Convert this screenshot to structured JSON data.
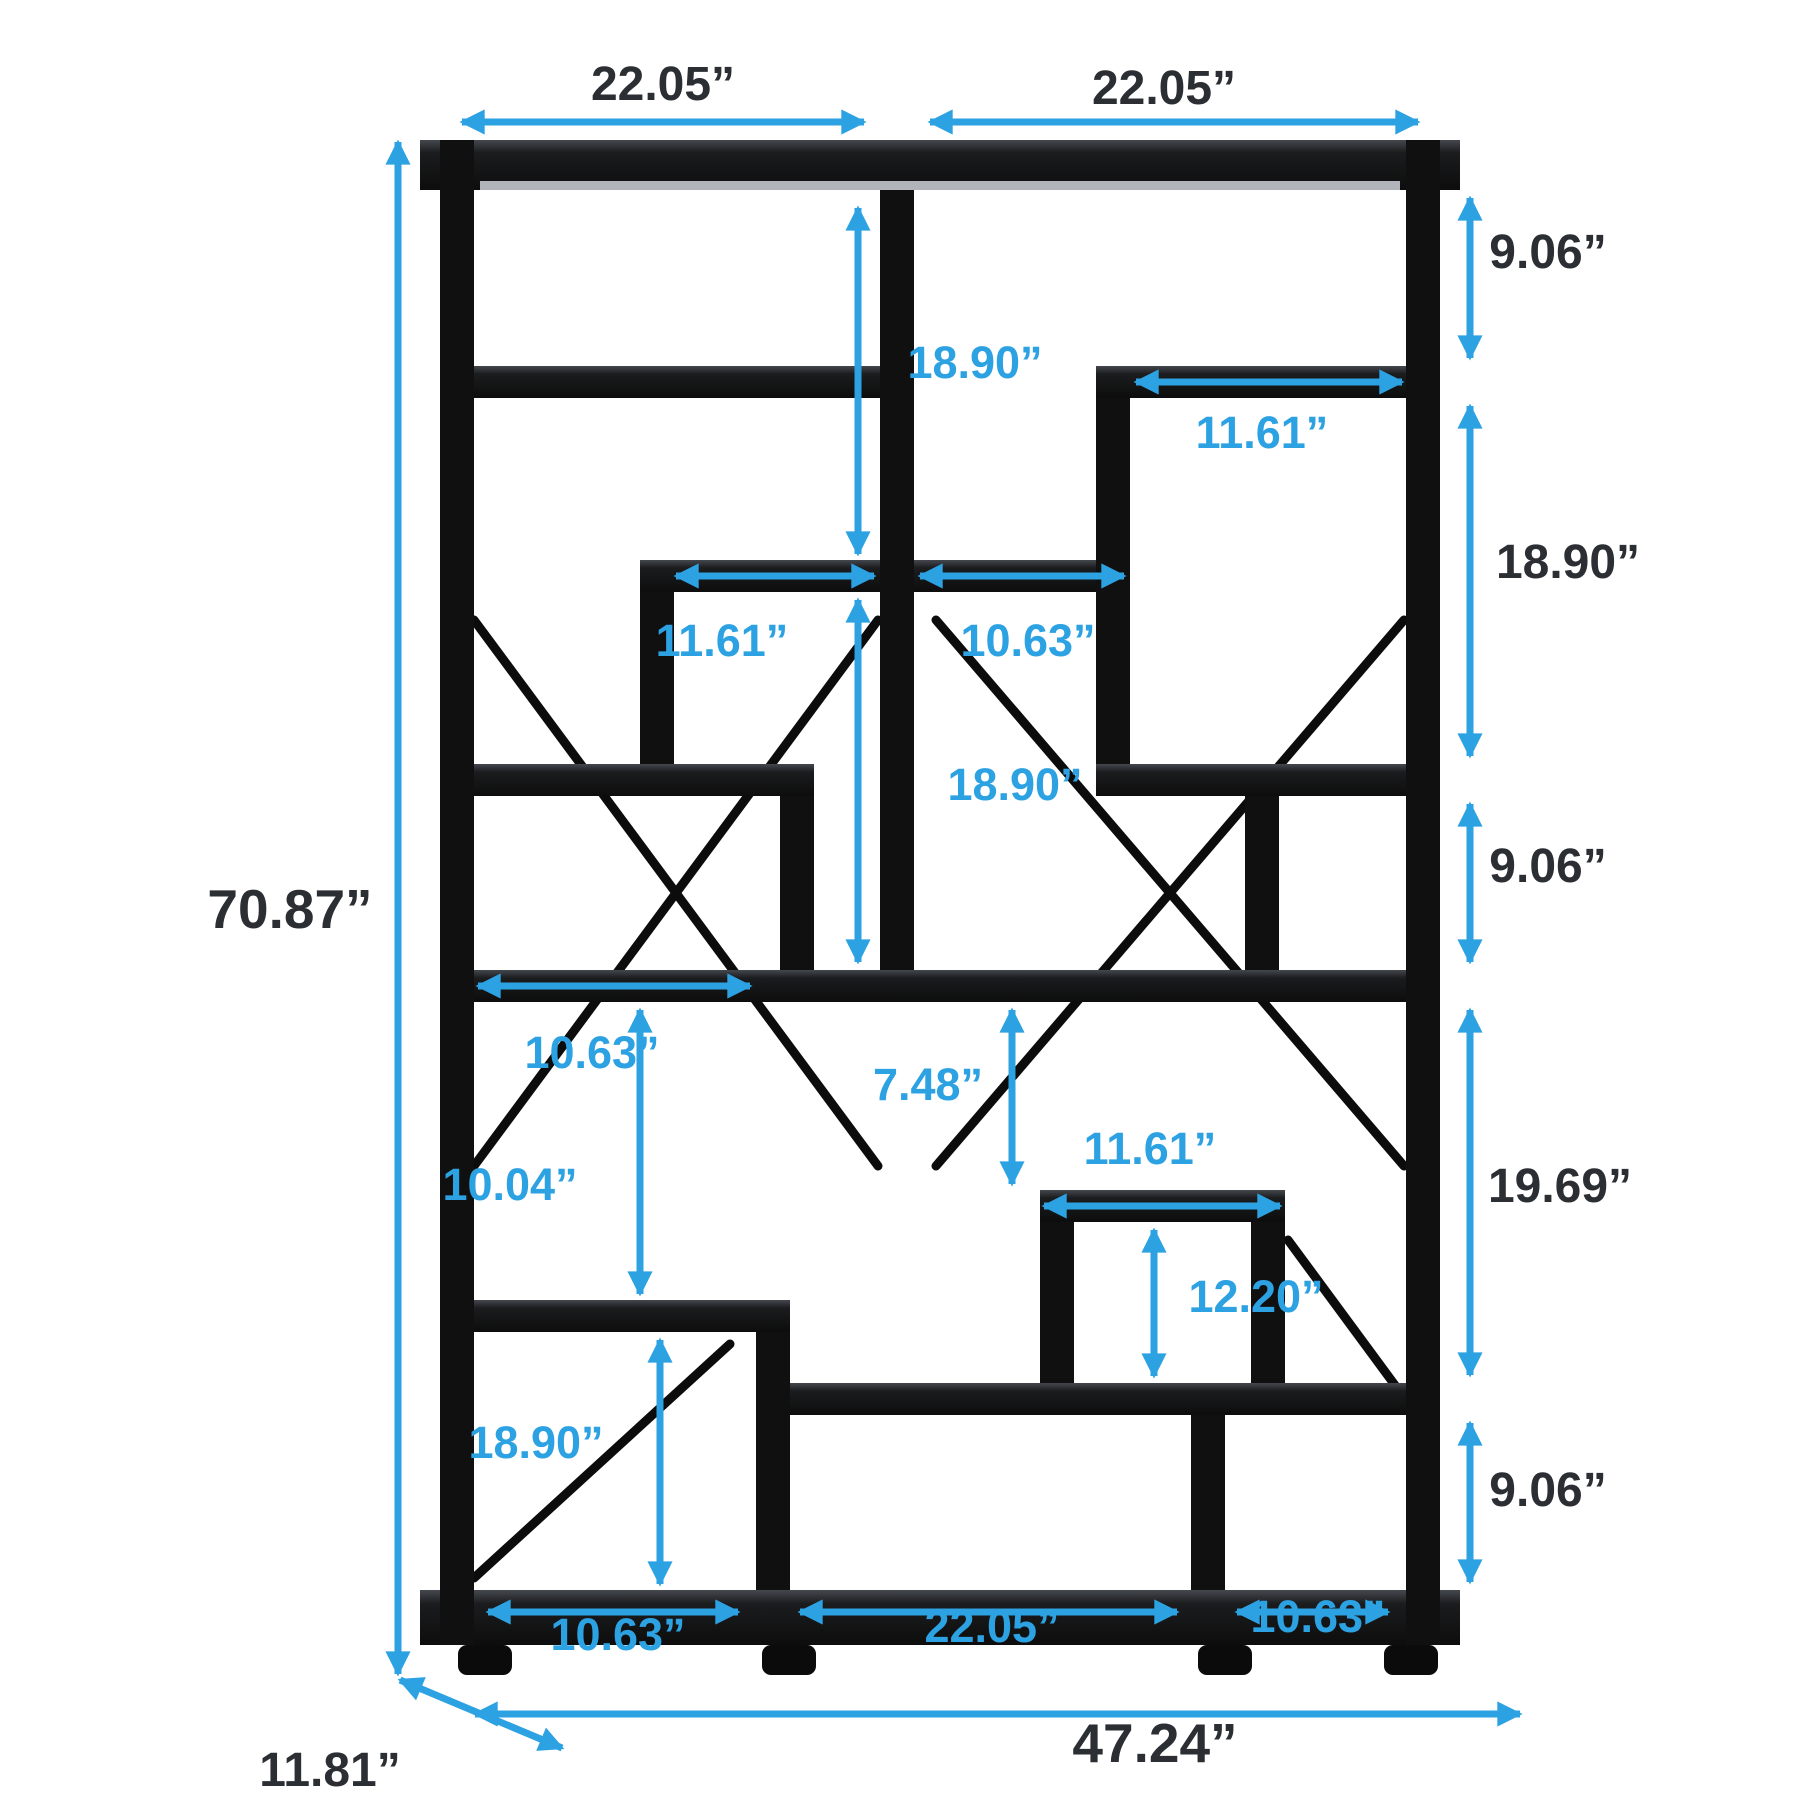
{
  "colors": {
    "accent": "#2da2e3",
    "ink": "#2b2e33",
    "frame": "#101010",
    "background": "#ffffff"
  },
  "labels": {
    "top_left_width": "22.05”",
    "top_right_width": "22.05”",
    "right_top_gap": "9.06”",
    "right_upper_gap": "18.90”",
    "right_middle_gap": "9.06”",
    "right_lower_gap": "19.69”",
    "right_bottom_gap": "9.06”",
    "total_height": "70.87”",
    "total_width": "47.24”",
    "depth": "11.81”",
    "center_top_gap": "18.90”",
    "top_box_width": "11.61”",
    "middle_shelf_left_width": "11.61”",
    "middle_shelf_right_width": "10.63”",
    "center_middle_gap": "18.90”",
    "left_cell_width": "10.63”",
    "left_lower_gap": "10.04”",
    "small_box_top_gap": "7.48”",
    "small_box_width": "11.61”",
    "small_box_height": "12.20”",
    "bottom_left_gap": "18.90”",
    "base_left_cell_width": "10.63”",
    "base_center_cell_width": "22.05”",
    "base_right_cell_width": "10.63”"
  }
}
